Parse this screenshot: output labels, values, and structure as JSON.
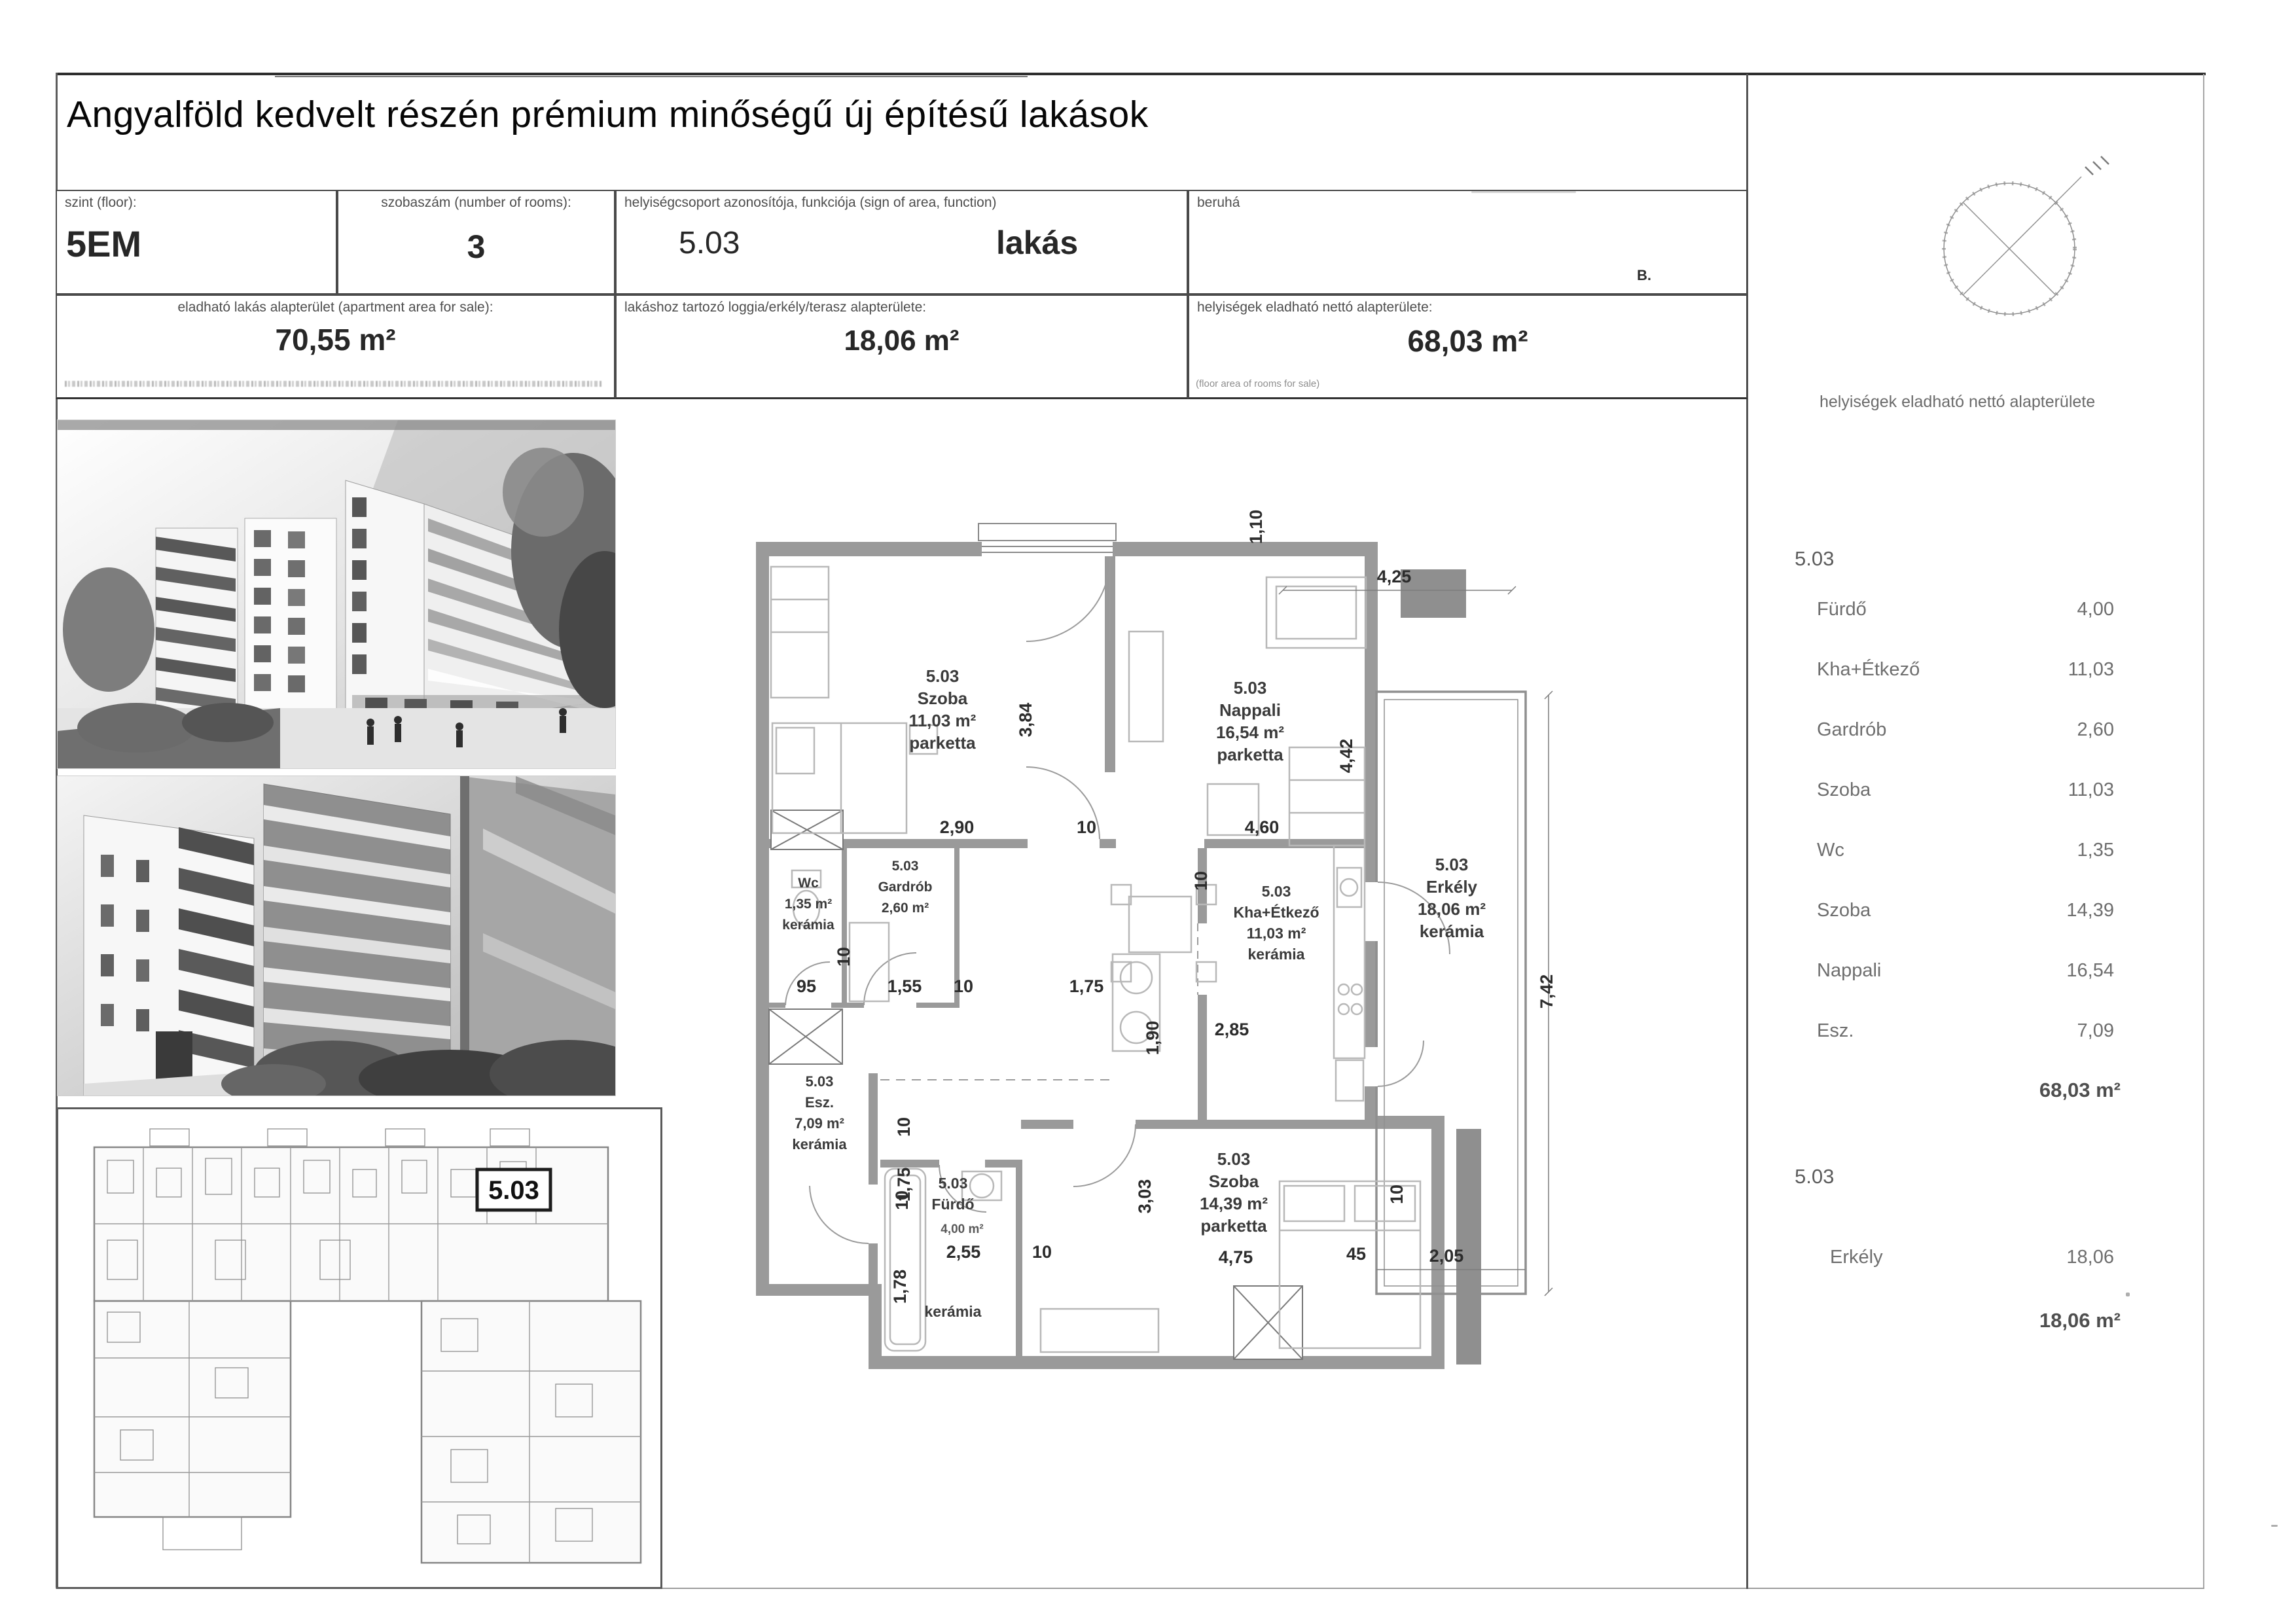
{
  "title": "Angyalföld kedvelt részén prémium minőségű új építésű lakások",
  "header": {
    "floor": {
      "label": "szint (floor):",
      "value": "5EM"
    },
    "rooms": {
      "label": "szobaszám (number of rooms):",
      "value": "3"
    },
    "unit": {
      "label": "helyiségcsoport azonosítója, funkciója (sign of area, function)",
      "id": "5.03",
      "function": "lakás"
    },
    "developer": {
      "label": "beruhá"
    },
    "stray_mark": "B.",
    "apartment_area": {
      "label": "eladható lakás alapterület (apartment area for sale):",
      "value": "70,55  m²"
    },
    "balcony_area": {
      "label": "lakáshoz tartozó loggia/erkély/terasz alapterülete:",
      "value": "18,06  m²"
    },
    "net_area": {
      "label": "helyiségek eladható nettó alapterülete:",
      "value": "68,03  m²",
      "footnote": "(floor area of rooms for sale)"
    }
  },
  "right_panel": {
    "header": "helyiségek eladható nettó alapterülete",
    "sections": [
      {
        "id": "5.03",
        "rows": [
          {
            "name": "Fürdő",
            "value": "4,00"
          },
          {
            "name": "Kha+Étkező",
            "value": "11,03"
          },
          {
            "name": "Gardrób",
            "value": "2,60"
          },
          {
            "name": "Szoba",
            "value": "11,03"
          },
          {
            "name": "Wc",
            "value": "1,35"
          },
          {
            "name": "Szoba",
            "value": "14,39"
          },
          {
            "name": "Nappali",
            "value": "16,54"
          },
          {
            "name": "Esz.",
            "value": "7,09"
          }
        ],
        "total": "68,03 m²"
      },
      {
        "id": "5.03",
        "rows": [
          {
            "name": "Erkély",
            "value": "18,06"
          }
        ],
        "total": "18,06 m²"
      }
    ]
  },
  "plan": {
    "overview_label": "5.03",
    "rooms": [
      {
        "id": "5.03",
        "name": "Szoba",
        "area": "11,03 m²",
        "floor": "parketta"
      },
      {
        "id": "5.03",
        "name": "Nappali",
        "area": "16,54 m²",
        "floor": "parketta"
      },
      {
        "id": "5.03",
        "name": "Erkély",
        "area": "18,06 m²",
        "floor": "kerámia"
      },
      {
        "id": "",
        "name": "Wc",
        "area": "1,35 m²",
        "floor": "kerámia"
      },
      {
        "id": "5.03",
        "name": "Gardrób",
        "area": "2,60 m²",
        "floor": ""
      },
      {
        "id": "5.03",
        "name": "Kha+Étkező",
        "area": "11,03 m²",
        "floor": "kerámia"
      },
      {
        "id": "5.03",
        "name": "Esz.",
        "area": "7,09 m²",
        "floor": "kerámia"
      },
      {
        "id": "5.03",
        "name": "Fürdő",
        "area": "4,00 m²",
        "floor": "kerámia"
      },
      {
        "id": "5.03",
        "name": "Szoba",
        "area": "14,39 m²",
        "floor": "parketta"
      }
    ],
    "dims": {
      "szoba1_w": "2,90",
      "szoba1_h": "3,84",
      "w10": "10",
      "nappali_w": "4,60",
      "nappali_h": "4,42",
      "erkely_top": "4,25",
      "erkely_left": "1,10",
      "erkely_right": "7,42",
      "erkely_bottom": "2,05",
      "erkely_wall": "45",
      "wc_w": "95",
      "gardrob_w": "1,55",
      "hall_w": "1,75",
      "kha_w": "2,85",
      "kha_h": "1,90",
      "esz_h": "1,75",
      "furdo_w": "2,55",
      "furdo_h": "1,78",
      "szoba2_w": "4,75",
      "szoba2_h": "3,03"
    }
  },
  "colors": {
    "wall_gray": "#9a9a9a",
    "scan_black": "#2e2e2e",
    "label_gray": "#6e6e6e"
  }
}
